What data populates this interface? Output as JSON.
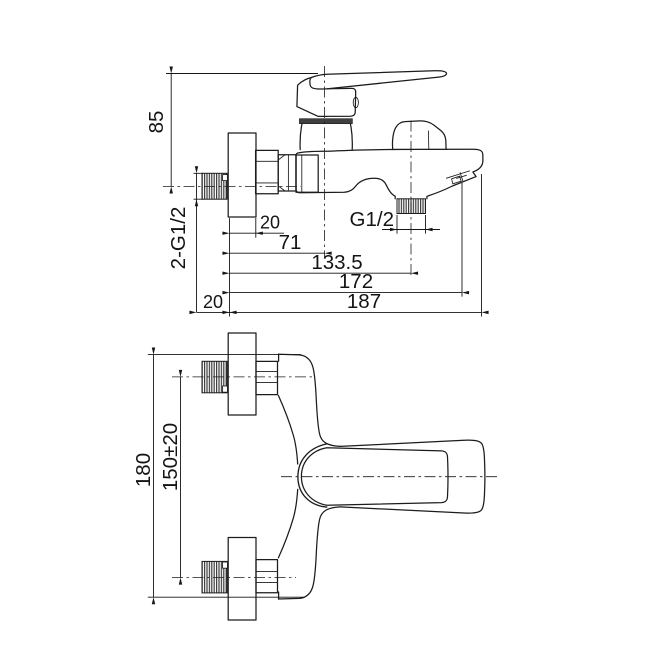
{
  "colors": {
    "background": "#ffffff",
    "line": "#1c1c1c",
    "thread_fill": "#3c3c3c"
  },
  "side_view": {
    "dims": {
      "height_to_handle": "85",
      "inlet_threads_label": "2-G1/2",
      "escutcheon_depth": "20",
      "wall_to_cartridge_axis": "71",
      "wall_to_shower_outlet": "133.5",
      "wall_to_aerator": "172",
      "wall_to_spout_end": "187",
      "thread_length": "20",
      "shower_outlet_thread": "G1/2"
    }
  },
  "front_view": {
    "dims": {
      "overall_body_height": "180",
      "inlet_center_spacing": "150±20"
    }
  }
}
